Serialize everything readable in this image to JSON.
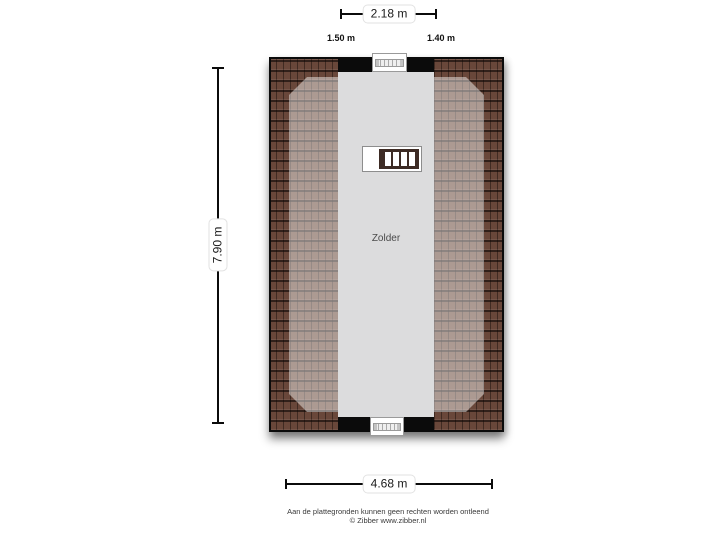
{
  "plan": {
    "room_label": "Zolder",
    "colors": {
      "background": "#ffffff",
      "roof_tile": "#69473a",
      "roof_grout": "#2a1b15",
      "roof_light_overlay": "rgba(255,255,255,0.45)",
      "floor": "#dcdcdd",
      "wall": "#0b0b0b",
      "stair_wood": "#3d2b24"
    }
  },
  "dimensions": {
    "top": {
      "label": "2.18 m"
    },
    "top_left": {
      "label": "1.50 m"
    },
    "top_right": {
      "label": "1.40 m"
    },
    "left": {
      "label": "7.90 m"
    },
    "bottom": {
      "label": "4.68 m"
    }
  },
  "icons": {
    "stairs": "stairs-icon",
    "window": "window-icon"
  },
  "footer": {
    "disclaimer": "Aan de plattegronden kunnen geen rechten worden ontleend",
    "copyright": "© Zibber www.zibber.nl"
  }
}
